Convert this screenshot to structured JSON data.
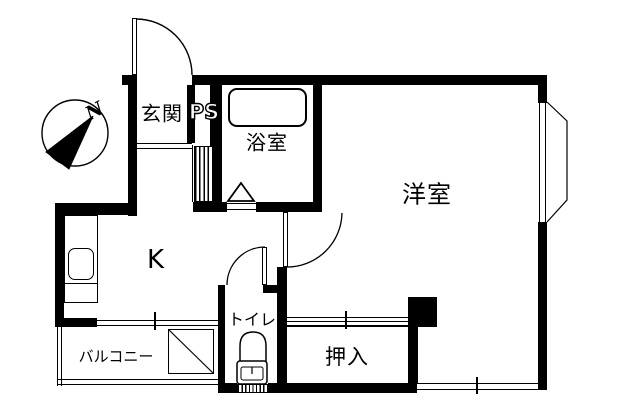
{
  "floorplan": {
    "title": "1K apartment floor plan",
    "compass": {
      "north_label": "N"
    },
    "rooms": {
      "genkan": {
        "label": "玄関"
      },
      "ps": {
        "label": "PS"
      },
      "bath": {
        "label": "浴室"
      },
      "western": {
        "label": "洋室"
      },
      "kitchen": {
        "label": "K"
      },
      "toilet": {
        "label": "トイレ"
      },
      "closet": {
        "label": "押入"
      },
      "balcony": {
        "label": "バルコニー"
      }
    },
    "colors": {
      "wall": "#000000",
      "background": "#ffffff",
      "line": "#000000"
    }
  }
}
